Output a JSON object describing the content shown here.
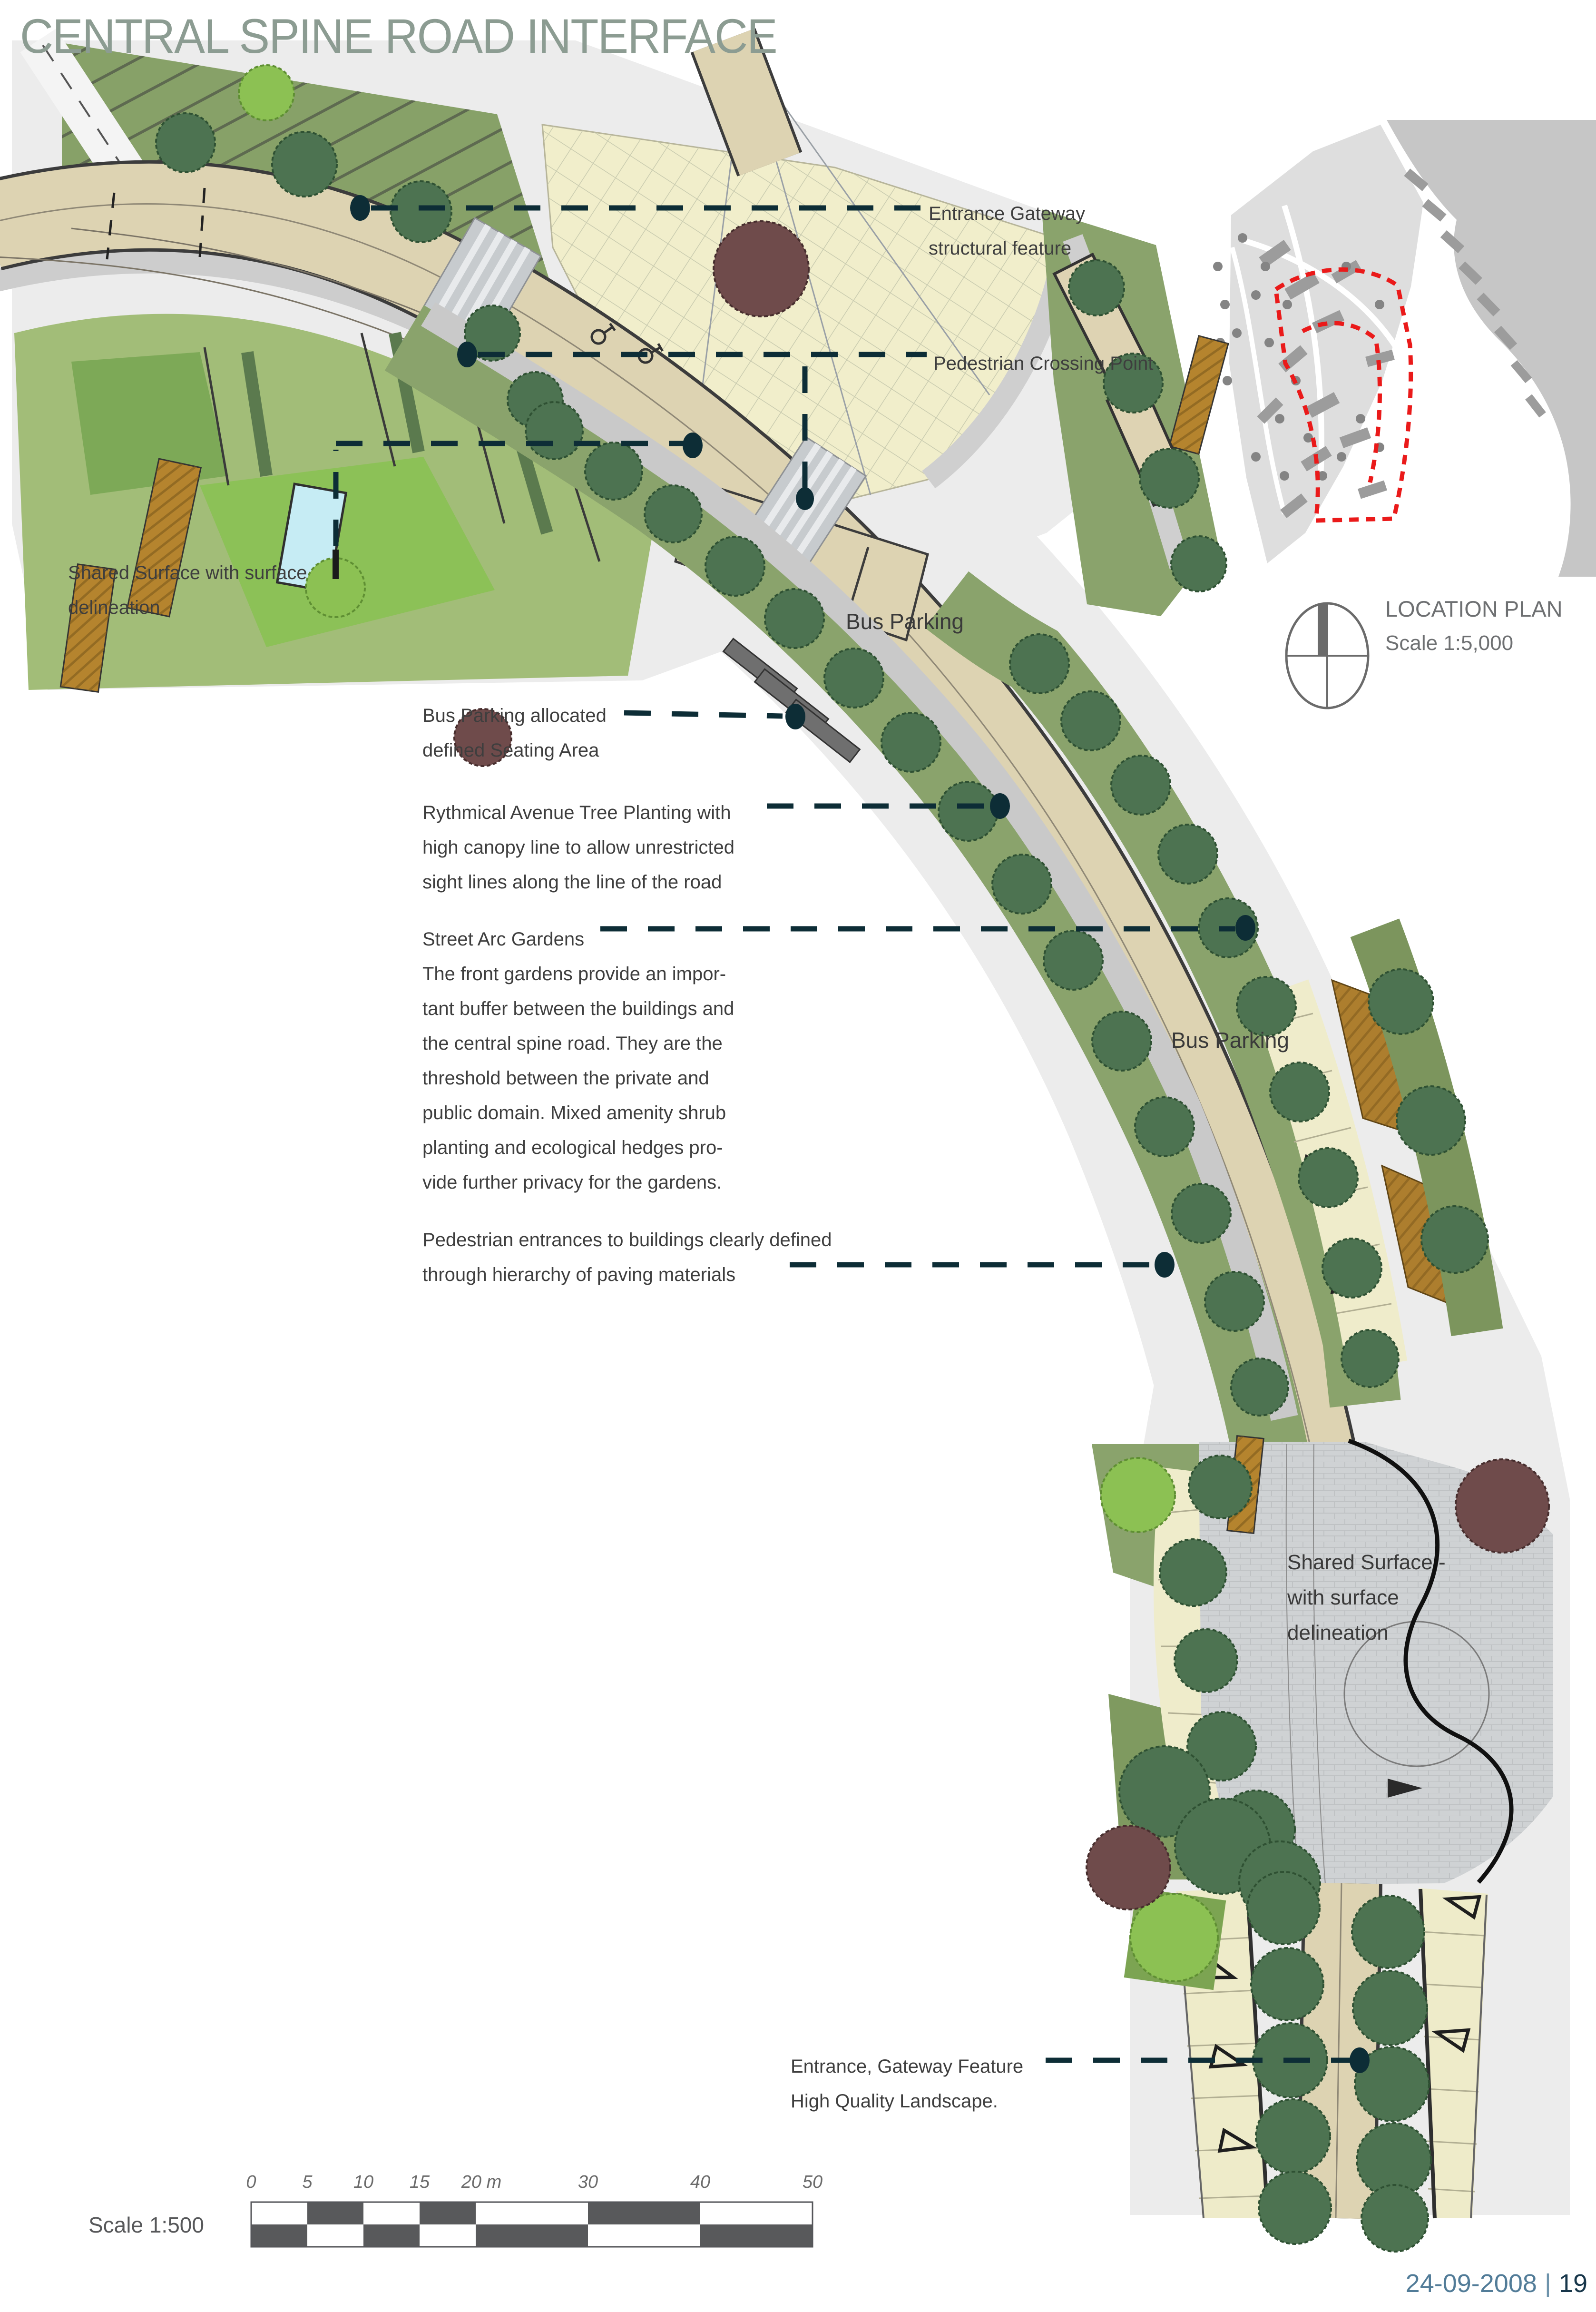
{
  "title": "CENTRAL SPINE ROAD INTERFACE",
  "annotations": {
    "entrance_gateway": {
      "lines": [
        "Entrance Gateway",
        "structural feature"
      ]
    },
    "pedestrian_crossing": {
      "lines": [
        "Pedestrian Crossing Point"
      ]
    },
    "shared_surface_left": {
      "lines": [
        "Shared Surface with surface",
        "delineation"
      ]
    },
    "bus_parking_seating": {
      "lines": [
        "Bus Parking allocated",
        "defined Seating Area"
      ]
    },
    "avenue_trees": {
      "lines": [
        "Rythmical Avenue Tree Planting with",
        "high canopy line to allow unrestricted",
        "sight lines along the line of the road"
      ]
    },
    "street_arc": {
      "lines": [
        "Street Arc  Gardens",
        "The front gardens provide an impor-",
        "tant buffer between the buildings and",
        "the central spine road.  They are the",
        "threshold between the private and",
        "public domain.  Mixed amenity shrub",
        "planting and ecological hedges pro-",
        "vide further privacy for the gardens."
      ]
    },
    "ped_entrances": {
      "lines": [
        "Pedestrian entrances to buildings clearly defined",
        "through hierarchy of paving materials"
      ]
    },
    "entrance_feature": {
      "lines": [
        "Entrance, Gateway Feature",
        "High Quality Landscape."
      ]
    }
  },
  "plan_labels": {
    "bus_parking_1": "Bus Parking",
    "bus_parking_2": "Bus Parking",
    "shared_surface": {
      "lines": [
        "Shared Surface -",
        "with surface",
        "delineation"
      ]
    }
  },
  "location_plan": {
    "title": "LOCATION PLAN",
    "scale": "Scale 1:5,000"
  },
  "scale_bar": {
    "label": "Scale 1:500",
    "ticks": [
      "0",
      "5",
      "10",
      "15",
      "20 m",
      "30",
      "40",
      "50"
    ]
  },
  "footer": {
    "date": "24-09-2008",
    "separator": "|",
    "page": "19"
  },
  "colors": {
    "title": "#8c9c92",
    "annotation_text": "#3e3e3e",
    "leader": "#0d2d36",
    "road_beige": "#ddd3b2",
    "plaza_cream": "#f1eecb",
    "verge_green": "#8aa36c",
    "shared_surface_gray": "#cfd2d4",
    "red_outline": "#ea1a1a",
    "footer_date": "#527c98",
    "footer_page": "#17364a",
    "scalebar_dark": "#58595b"
  }
}
